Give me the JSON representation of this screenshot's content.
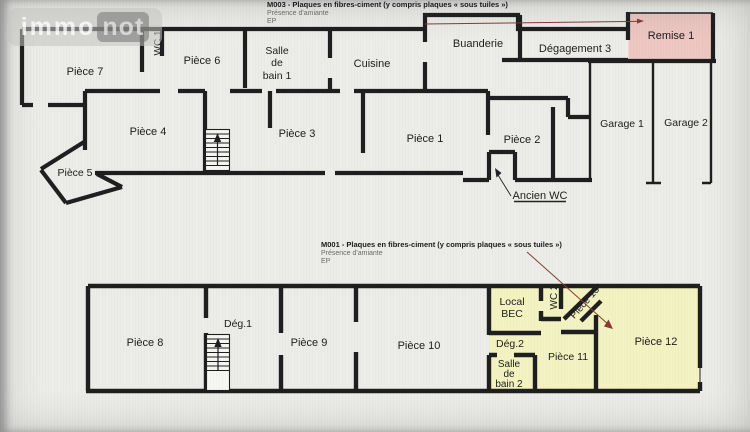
{
  "watermark": {
    "immo": "immo",
    "not": "not"
  },
  "colors": {
    "wall": "#1f1f1f",
    "highlight_pink": "#eec7c2",
    "highlight_yellow": "#f3f3c2",
    "leader_line": "#8a3c34"
  },
  "top_plan": {
    "annotation": {
      "title": "M003 - Plaques en fibres-ciment (y compris plaques « sous tuiles »)",
      "line2": "Présence d'amiante",
      "line3": "EP"
    },
    "rooms": {
      "piece7": "Pièce 7",
      "wc1": "WC 1",
      "piece6": "Pièce 6",
      "salle_bain1": [
        "Salle",
        "de",
        "bain 1"
      ],
      "cuisine": "Cuisine",
      "buanderie": "Buanderie",
      "degagement3": "Dégagement 3",
      "remise1": "Remise 1",
      "piece4": "Pièce 4",
      "piece5": "Pièce 5",
      "piece3": "Pièce 3",
      "piece1": "Pièce 1",
      "piece2": "Pièce 2",
      "garage1": "Garage 1",
      "garage2": "Garage 2",
      "ancien_wc": "Ancien WC"
    }
  },
  "bottom_plan": {
    "annotation": {
      "title": "M001 - Plaques en fibres-ciment (y compris plaques « sous tuiles »)",
      "line2": "Présence d'amiante",
      "line3": "EP"
    },
    "rooms": {
      "piece8": "Pièce 8",
      "deg1": "Dég.1",
      "piece9": "Pièce 9",
      "piece10": "Pièce 10",
      "local_bec": [
        "Local",
        "BEC"
      ],
      "wc2": "WC 2",
      "piece13": "Pièce 13",
      "deg2": "Dég.2",
      "piece11": "Pièce 11",
      "salle_bain2": [
        "Salle",
        "de",
        "bain 2"
      ],
      "piece12": "Pièce 12"
    }
  }
}
